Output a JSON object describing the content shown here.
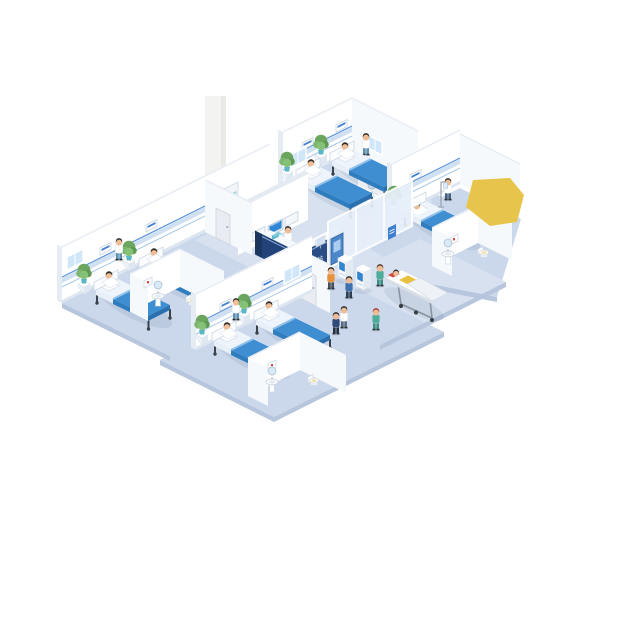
{
  "scene": {
    "desk_sign_text": "护士站",
    "palette": {
      "floor": "#cbd8ec",
      "floor2": "#d7e1f0",
      "floorside": "#b7c6dc",
      "wall": "#ffffff",
      "wallshade": "#f6f9fc",
      "wallside": "#e6ecf4",
      "rail": "#cfe0f2",
      "railline": "#5b93d8",
      "railthin": "#aac9e8",
      "base": "#dde6f0",
      "top": "#e9eef5",
      "blanket": "#3f8ed2",
      "blanket2": "#2f7cbf",
      "blanket3": "#2a6fae",
      "sheet": "#eef4fb",
      "navy": "#22437a",
      "navy2": "#2a4d85",
      "navyD": "#1b3760",
      "glass": "#e7f0fa",
      "screen": "#2f86d4",
      "green": "#6ba55e",
      "teal": "#58b7c8",
      "yellow": "#e7c44c",
      "red": "#cf4a44",
      "skin": "#eebd96"
    },
    "objects": [
      {
        "layer": "pharmacy",
        "type": "cabinet",
        "name": "medicine-cabinet",
        "x": 214,
        "y": 222
      },
      {
        "layer": "pharmacy",
        "type": "person",
        "name": "pharmacist",
        "x": 229,
        "y": 224,
        "coat": "#ffffff",
        "pants": "#4a6f94",
        "hair": "#3a332e"
      },
      {
        "layer": "cbath",
        "type": "picture",
        "name": "bathroom-c-picture",
        "x": 370,
        "y": 182
      },
      {
        "layer": "cbath",
        "type": "sink",
        "name": "bathroom-c-sink",
        "x": 372,
        "y": 206
      },
      {
        "layer": "wardC",
        "type": "plaque",
        "name": "ward-c-bed-plaque-1",
        "x": 302,
        "y": 143
      },
      {
        "layer": "wardC",
        "type": "plaque",
        "name": "ward-c-bed-plaque-2",
        "x": 336,
        "y": 125
      },
      {
        "layer": "wardC",
        "type": "windowL",
        "name": "ward-c-window",
        "x": 290,
        "y": 168
      },
      {
        "layer": "wardC",
        "type": "windowR",
        "name": "ward-c-side-window",
        "x": 368,
        "y": 148
      },
      {
        "layer": "wardC",
        "type": "plant",
        "name": "ward-c-plant-1",
        "x": 287,
        "y": 180
      },
      {
        "layer": "wardC",
        "type": "plant",
        "name": "ward-c-plant-2",
        "x": 321,
        "y": 163
      },
      {
        "layer": "wardC",
        "type": "person",
        "name": "ward-c-nurse",
        "x": 366,
        "y": 155,
        "coat": "#ffffff",
        "pants": "#5d8fb0",
        "hair": "#2f2b28"
      },
      {
        "layer": "wardC",
        "type": "bedSit",
        "name": "ward-c-bed-1",
        "x": 298,
        "y": 178
      },
      {
        "layer": "wardC",
        "type": "bedSit",
        "name": "ward-c-bed-2",
        "x": 332,
        "y": 161
      },
      {
        "layer": "wardD",
        "type": "plaque",
        "name": "ward-d-bed-plaque",
        "x": 410,
        "y": 175
      },
      {
        "layer": "wardD",
        "type": "plant",
        "name": "ward-d-plant",
        "x": 394,
        "y": 214
      },
      {
        "layer": "wardD",
        "type": "person",
        "name": "ward-d-nurse",
        "x": 448,
        "y": 200,
        "coat": "#ffffff",
        "pants": "#44607f",
        "hair": "#2f2b28"
      },
      {
        "layer": "wardD",
        "type": "iv",
        "name": "iv-stand",
        "x": 441,
        "y": 206
      },
      {
        "layer": "wardD",
        "type": "bedLie",
        "name": "ward-d-bed",
        "x": 404,
        "y": 212
      },
      {
        "layer": "dbath",
        "type": "picture",
        "name": "bathroom-d-picture",
        "x": 450,
        "y": 238
      },
      {
        "layer": "dbath",
        "type": "sink",
        "name": "bathroom-d-sink",
        "x": 448,
        "y": 264
      },
      {
        "layer": "dbath",
        "type": "toilet",
        "name": "bathroom-d-toilet",
        "x": 484,
        "y": 257
      },
      {
        "layer": "deskNurse",
        "type": "person",
        "name": "reception-nurse",
        "x": 288,
        "y": 248,
        "coat": "#ffffff",
        "pants": "#44607f",
        "hair": "#2f2b28"
      },
      {
        "layer": "deskItems",
        "type": "deskMonitor",
        "name": "desk-monitor",
        "x": 316,
        "y": 247
      },
      {
        "layer": "deskItems",
        "type": "tealbox",
        "name": "desk-supplies-box",
        "x": 272,
        "y": 240
      },
      {
        "layer": "kioskBack",
        "type": "doorBlue",
        "name": "corridor-blue-door",
        "x": 331,
        "y": 265
      },
      {
        "layer": "kioskBack",
        "type": "poster",
        "name": "corridor-poster",
        "x": 388,
        "y": 240
      },
      {
        "layer": "aright",
        "type": "door",
        "name": "ward-a-door",
        "x": 216,
        "y": 238
      },
      {
        "layer": "wardA",
        "type": "windowL",
        "name": "ward-a-window",
        "x": 67,
        "y": 270
      },
      {
        "layer": "wardA",
        "type": "plaque",
        "name": "ward-a-bed-plaque-1",
        "x": 100,
        "y": 248
      },
      {
        "layer": "wardA",
        "type": "plaque",
        "name": "ward-a-bed-plaque-2",
        "x": 146,
        "y": 225
      },
      {
        "layer": "wardA",
        "type": "plant",
        "name": "ward-a-plant-1",
        "x": 84,
        "y": 292
      },
      {
        "layer": "wardA",
        "type": "plant",
        "name": "ward-a-plant-2",
        "x": 129,
        "y": 269
      },
      {
        "layer": "wardA",
        "type": "person",
        "name": "ward-a-nurse",
        "x": 119,
        "y": 260,
        "coat": "#ffffff",
        "pants": "#5d8fb0",
        "hair": "#2f2b28"
      },
      {
        "layer": "wardA",
        "type": "bedSit",
        "name": "ward-a-bed-1",
        "x": 96,
        "y": 290
      },
      {
        "layer": "wardA",
        "type": "bedSit",
        "name": "ward-a-bed-2",
        "x": 141,
        "y": 267
      },
      {
        "layer": "abath",
        "type": "picture",
        "name": "bathroom-a-picture",
        "x": 144,
        "y": 281
      },
      {
        "layer": "abath",
        "type": "sink",
        "name": "bathroom-a-sink",
        "x": 158,
        "y": 306
      },
      {
        "layer": "abath",
        "type": "toilet",
        "name": "bathroom-a-toilet",
        "x": 192,
        "y": 305
      },
      {
        "layer": "bright",
        "type": "door",
        "name": "ward-b-door",
        "x": 302,
        "y": 299
      },
      {
        "layer": "wardB",
        "type": "plaque",
        "name": "ward-b-bed-plaque-1",
        "x": 220,
        "y": 304
      },
      {
        "layer": "wardB",
        "type": "plaque",
        "name": "ward-b-bed-plaque-2",
        "x": 262,
        "y": 283
      },
      {
        "layer": "wardB",
        "type": "windowL",
        "name": "ward-b-window",
        "x": 284,
        "y": 284
      },
      {
        "layer": "wardB",
        "type": "plant",
        "name": "ward-b-plant-1",
        "x": 202,
        "y": 343
      },
      {
        "layer": "wardB",
        "type": "plant",
        "name": "ward-b-plant-2",
        "x": 244,
        "y": 322
      },
      {
        "layer": "wardB",
        "type": "person",
        "name": "ward-b-nurse",
        "x": 236,
        "y": 320,
        "coat": "#ffffff",
        "pants": "#5d8fb0",
        "hair": "#2f2b28"
      },
      {
        "layer": "wardB",
        "type": "bedSit",
        "name": "ward-b-bed-1",
        "x": 214,
        "y": 341
      },
      {
        "layer": "wardB",
        "type": "bedSit",
        "name": "ward-b-bed-2",
        "x": 256,
        "y": 320
      },
      {
        "layer": "bbath",
        "type": "picture",
        "name": "bathroom-b-picture",
        "x": 268,
        "y": 364
      },
      {
        "layer": "bbath",
        "type": "sink",
        "name": "bathroom-b-sink",
        "x": 272,
        "y": 392
      },
      {
        "layer": "bbath",
        "type": "toilet",
        "name": "bathroom-b-toilet",
        "x": 314,
        "y": 385
      },
      {
        "layer": "corridorFront",
        "type": "kiosk",
        "name": "selfservice-kiosk-1",
        "x": 338,
        "y": 276
      },
      {
        "layer": "corridorFront",
        "type": "kiosk",
        "name": "selfservice-kiosk-2",
        "x": 356,
        "y": 286
      },
      {
        "layer": "corridorFront",
        "type": "person",
        "name": "kiosk-user-1",
        "x": 331,
        "y": 289,
        "coat": "#e8923e",
        "pants": "#4a4f57",
        "hair": "#2f2b28"
      },
      {
        "layer": "corridorFront",
        "type": "person",
        "name": "kiosk-user-2",
        "x": 349,
        "y": 298,
        "coat": "#3e6fae",
        "pants": "#2c3e50",
        "hair": "#2f2b28"
      },
      {
        "layer": "corridorFront",
        "type": "person",
        "name": "stretcher-nurse",
        "x": 380,
        "y": 286,
        "coat": "#4fae9b",
        "pants": "#3f8f80",
        "hair": "#553c2e"
      },
      {
        "layer": "corridorFront",
        "type": "stretcher",
        "name": "patient-stretcher",
        "x": 386,
        "y": 278
      },
      {
        "layer": "corridorFront",
        "type": "person",
        "name": "walking-doctor",
        "x": 336,
        "y": 334,
        "coat": "#2e4a7a",
        "pants": "#22303f",
        "hair": "#2f2b28"
      },
      {
        "layer": "corridorFront",
        "type": "person",
        "name": "walking-patient",
        "x": 344,
        "y": 328,
        "coat": "#ffffff",
        "pants": "#5a6c80",
        "hair": "#2f2b28"
      },
      {
        "layer": "corridorFront",
        "type": "person",
        "name": "walking-nurse-green",
        "x": 376,
        "y": 330,
        "coat": "#4fae9b",
        "pants": "#3f8f80",
        "hair": "#b03a34"
      }
    ]
  }
}
